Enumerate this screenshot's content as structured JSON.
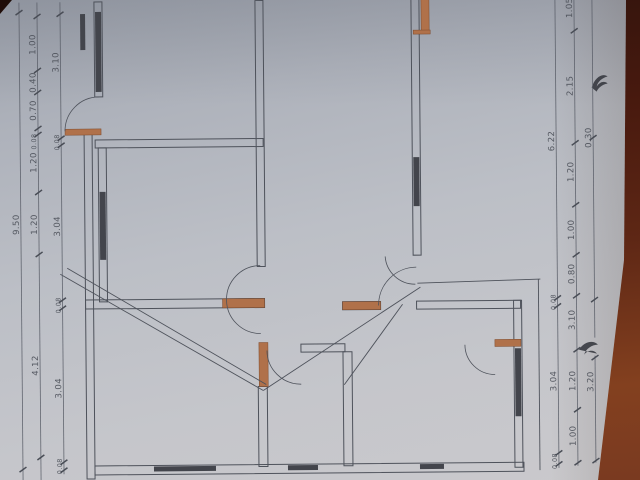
{
  "photo": {
    "line_color": "#4e525b",
    "dim_line_color": "#585c66",
    "window_color": "#43454c",
    "accent_orange": "#b0714a",
    "accent_orange_edge": "#7d4a2c",
    "label_color": "#494d56",
    "ink_color": "#30333a",
    "paper_color": "#bcbfc6",
    "table_color": "#5e2715"
  },
  "plan": {
    "walls": [
      [
        96,
        0,
        8,
        95
      ],
      [
        85,
        130,
        8,
        347
      ],
      [
        99,
        146,
        8,
        154
      ],
      [
        257,
        0,
        8,
        266
      ],
      [
        257,
        386,
        9,
        80
      ],
      [
        413,
        0,
        8,
        256
      ],
      [
        513,
        302,
        8,
        167
      ],
      [
        342,
        352,
        9,
        114
      ],
      [
        96,
        138,
        168,
        8
      ],
      [
        85,
        298,
        179,
        9
      ],
      [
        300,
        344,
        44,
        8
      ],
      [
        342,
        302,
        38,
        8
      ],
      [
        416,
        302,
        104,
        8
      ],
      [
        93,
        464,
        429,
        9
      ]
    ],
    "windows": [
      [
        97,
        10,
        6,
        80
      ],
      [
        100,
        190,
        6,
        68
      ],
      [
        414,
        158,
        6,
        49
      ],
      [
        514,
        350,
        6,
        68
      ],
      [
        152,
        465,
        62,
        5
      ],
      [
        286,
        465,
        30,
        5
      ],
      [
        418,
        465,
        24,
        5
      ],
      [
        82,
        12,
        5,
        36
      ]
    ],
    "orange_segments": [
      [
        423,
        0,
        8,
        33
      ],
      [
        415,
        31,
        17,
        4
      ],
      [
        66,
        127,
        36,
        6
      ],
      [
        222,
        298,
        42,
        9
      ],
      [
        258,
        342,
        9,
        44
      ],
      [
        342,
        302,
        38,
        8
      ],
      [
        494,
        341,
        26,
        7
      ]
    ],
    "door_arcs": [
      "M100,95 A34,34 0 0 0 66,129",
      "M260,265 A34,34 0 0 0 260,333",
      "M266,350 A34,34 0 0 0 300,384",
      "M378,306 A38,38 0 0 1 416,268",
      "M464,346 A30,30 0 0 0 494,376",
      "M385,257 A30,30 0 0 0 415,285"
    ],
    "diagonals": [
      [
        60,
        272,
        262,
        390
      ],
      [
        67,
        266,
        265,
        384
      ],
      [
        262,
        390,
        420,
        288
      ],
      [
        343,
        385,
        402,
        305
      ]
    ],
    "single_lines": [
      [
        417,
        284,
        540,
        281
      ],
      [
        538,
        281,
        538,
        472
      ]
    ],
    "artifacts": [
      "M593,90 C596,80 604,75 609,79 C604,80 599,84 598,89 C601,84 606,83 609,86 C603,87 599,91 598,94 Z",
      "M578,352 C583,344 592,342 597,347 C591,347 585,351 583,357 C587,352 593,352 596,356 Z"
    ]
  },
  "dimensions": {
    "chains": [
      {
        "side": "left",
        "x": 21,
        "segs": [
          [
            0,
            478
          ]
        ],
        "ticks": [
          10,
          467
        ],
        "labels": [
          {
            "t": "9.50",
            "y": 222
          }
        ]
      },
      {
        "side": "left",
        "x": 39,
        "segs": [
          [
            0,
            478
          ]
        ],
        "ticks": [
          14,
          68,
          90,
          126,
          132,
          190,
          252,
          455
        ],
        "labels": [
          {
            "t": "1.00",
            "y": 42
          },
          {
            "t": "0.40",
            "y": 80
          },
          {
            "t": "0.70",
            "y": 108
          },
          {
            "t": "0.08",
            "y": 139,
            "fs": 6.5
          },
          {
            "t": "1.20",
            "y": 160
          },
          {
            "t": "1.20",
            "y": 222
          },
          {
            "t": "4.12",
            "y": 363
          }
        ]
      },
      {
        "side": "left",
        "x": 62,
        "segs": [
          [
            0,
            472
          ]
        ],
        "ticks": [
          12,
          136,
          143,
          298,
          306,
          460,
          468
        ],
        "labels": [
          {
            "t": "3.10",
            "y": 60
          },
          {
            "t": "0.08",
            "y": 140,
            "fs": 6.5
          },
          {
            "t": "3.04",
            "y": 224
          },
          {
            "t": "0.08",
            "y": 303,
            "fs": 6.5
          },
          {
            "t": "3.04",
            "y": 386
          },
          {
            "t": "0.08",
            "y": 464,
            "fs": 6.5
          }
        ]
      },
      {
        "side": "right",
        "x": 557,
        "segs": [
          [
            0,
            470
          ]
        ],
        "ticks": [
          300,
          308,
          455,
          466
        ],
        "labels": [
          {
            "t": "6.22",
            "y": 143
          },
          {
            "t": "0.08",
            "y": 304,
            "fs": 6.5
          },
          {
            "t": "3.04",
            "y": 383
          },
          {
            "t": "0.08",
            "y": 463,
            "fs": 6.5
          }
        ]
      },
      {
        "side": "right",
        "x": 576,
        "segs": [
          [
            0,
            468
          ]
        ],
        "ticks": [
          33,
          145,
          207,
          257,
          298,
          352,
          412,
          465
        ],
        "labels": [
          {
            "t": "1.05",
            "y": 10
          },
          {
            "t": "2.15",
            "y": 88
          },
          {
            "t": "1.20",
            "y": 174
          },
          {
            "t": "1.00",
            "y": 232
          },
          {
            "t": "0.80",
            "y": 276
          },
          {
            "t": "3.10",
            "y": 322
          },
          {
            "t": "1.20",
            "y": 383
          },
          {
            "t": "1.00",
            "y": 438
          }
        ]
      },
      {
        "side": "right",
        "x": 594,
        "segs": [
          [
            0,
            340
          ],
          [
            358,
            465
          ]
        ],
        "ticks": [
          140,
          302,
          360,
          463
        ],
        "labels": [
          {
            "t": "0.30",
            "y": 140
          },
          {
            "t": "3.20",
            "y": 384
          }
        ]
      }
    ]
  }
}
